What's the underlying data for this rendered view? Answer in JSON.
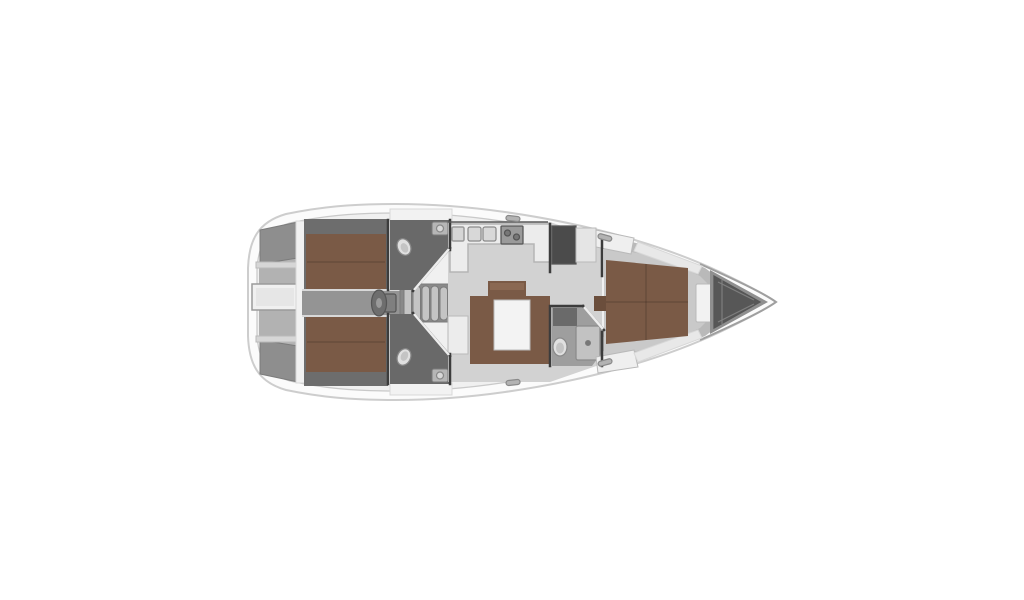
{
  "page": {
    "background": "#ffffff"
  },
  "diagram": {
    "type": "yacht-interior-floorplan",
    "subject": "sailing-yacht-3-cabin-layout-top-view-bow-right",
    "colors": {
      "background": "#ffffff",
      "hull": "#fbfbfb",
      "deck": "#f0f0f0",
      "deckBand": "#f1f1f1",
      "sternGray": "#b2b2b2",
      "seatGray": "#8e8e8e",
      "shelfGray": "#d6d6d6",
      "platformWhite": "#f0f0f0",
      "platformInner": "#e6e6e6",
      "cabinShadow": "#6d6d6d",
      "wood": "#7a5a46",
      "woodLight": "#8a6852",
      "woodDark": "#6b4e3c",
      "corridor": "#949494",
      "stepBase": "#898989",
      "stepRib": "#c4c4c4",
      "wheelGray": "#6e6e6e",
      "wheelHub": "#9a9a9a",
      "pedestal": "#7f7f7f",
      "headFloor": "#696969",
      "fwdHeadFloor": "#9e9e9e",
      "porcelain": "#e0e0e0",
      "porcelainInner": "#c4c4c4",
      "sinkGray": "#b6b6b6",
      "sinkBasin": "#d8d8d8",
      "counterWhite": "#ececec",
      "trayGray": "#d6d6d6",
      "stoveGray": "#9a9a9a",
      "burnerGray": "#777777",
      "navDark": "#4b4b4b",
      "chartLight": "#e5e5e5",
      "salonFloor": "#d2d2d2",
      "tableWhite": "#f3f3f3",
      "chaiseWhite": "#ececec",
      "coachroofWhite": "#f2f2f2",
      "cabinetDark": "#6a6a6a",
      "showerGray": "#c2c2c2",
      "fwdFloorOuter": "#b9b9b9",
      "fwdFloorInner": "#c9c9c9",
      "shelfWhite": "#efefef",
      "shelfWhite2": "#e8e8e8",
      "hatchWhite": "#f2f2f2",
      "hatchTab": "#d7d7d7",
      "bowGray": "#8f8f8f",
      "lockerDark": "#575757",
      "hardware": "#b3b3b3",
      "wedgeWhite": "#ececec",
      "thresholdWhite": "#e8e8e8"
    },
    "parts": [
      "hull",
      "side-deck",
      "swim-platform",
      "stern-deck",
      "helm-seat-port",
      "helm-seat-starboard",
      "aft-cabin-port",
      "aft-berth-port",
      "aft-cabin-starboard",
      "aft-berth-starboard",
      "cockpit-corridor",
      "steering-wheel",
      "companionway-steps",
      "aft-head-port",
      "aft-head-starboard",
      "toilet",
      "washbasin",
      "galley",
      "galley-sinks",
      "galley-stove",
      "navigation-cabinet",
      "chart-locker",
      "salon",
      "salon-sofa",
      "salon-table",
      "salon-bench",
      "salon-chaise",
      "forward-head",
      "shower-tray",
      "forward-cabin",
      "forward-berth",
      "nightstand",
      "side-shelves",
      "deck-hatch",
      "anchor-locker",
      "deck-cleats"
    ]
  }
}
